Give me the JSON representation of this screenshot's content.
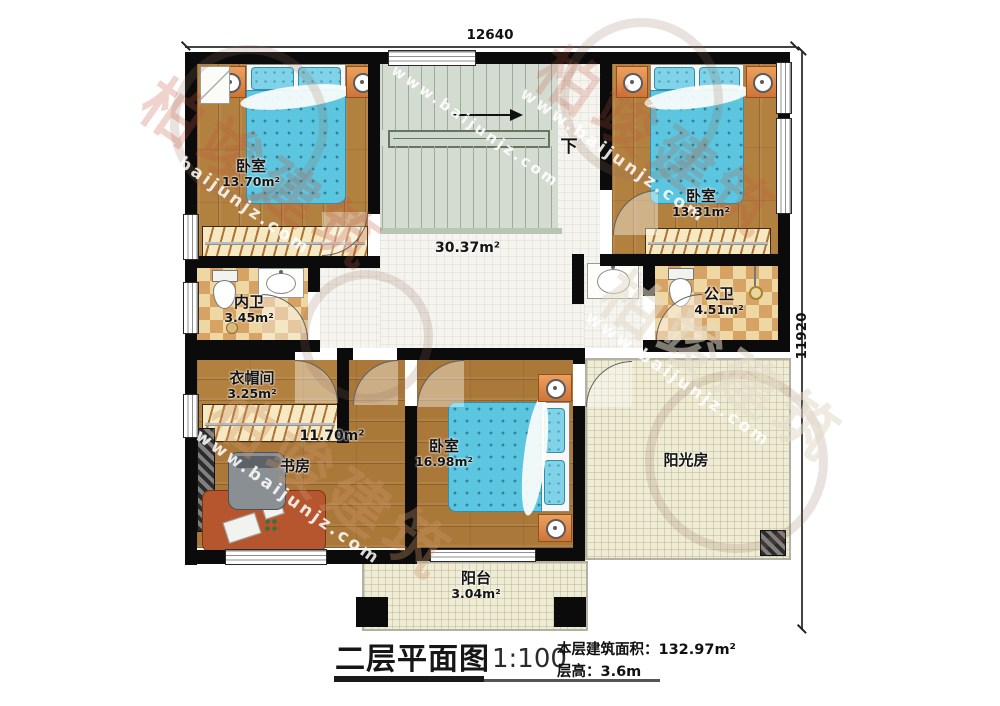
{
  "dimensions": {
    "width_top": "12640",
    "height_right": "11920"
  },
  "stairs": {
    "down": "下"
  },
  "rooms": {
    "bedroom_tl": {
      "name": "卧室",
      "area": "13.70m²"
    },
    "bedroom_tr": {
      "name": "卧室",
      "area": "13.31m²"
    },
    "hall": {
      "area": "30.37m²"
    },
    "bath_inner": {
      "name": "内卫",
      "area": "3.45m²"
    },
    "bath_public": {
      "name": "公卫",
      "area": "4.51m²"
    },
    "cloakroom": {
      "name": "衣帽间",
      "area": "3.25m²"
    },
    "study": {
      "name": "书房",
      "area": "11.70m²"
    },
    "bedroom_bottom": {
      "name": "卧室",
      "area": "16.98m²"
    },
    "sunroom": {
      "name": "阳光房"
    },
    "balcony": {
      "name": "阳台",
      "area": "3.04m²"
    }
  },
  "title_block": {
    "title": "二层平面图",
    "scale": "1:100",
    "floor_area": "本层建筑面积：132.97m²",
    "floor_height": "层高：3.6m"
  },
  "watermark": {
    "brand": "柏竣建筑",
    "site": "www.baijunjz.com"
  },
  "colors": {
    "wall": "#0b0b0b",
    "wood": "#b2803f",
    "bed_blue": "#5cc6e0",
    "checker": "#d6a365",
    "tile_beige": "#efecd6",
    "stair": "#d4dcd2"
  }
}
